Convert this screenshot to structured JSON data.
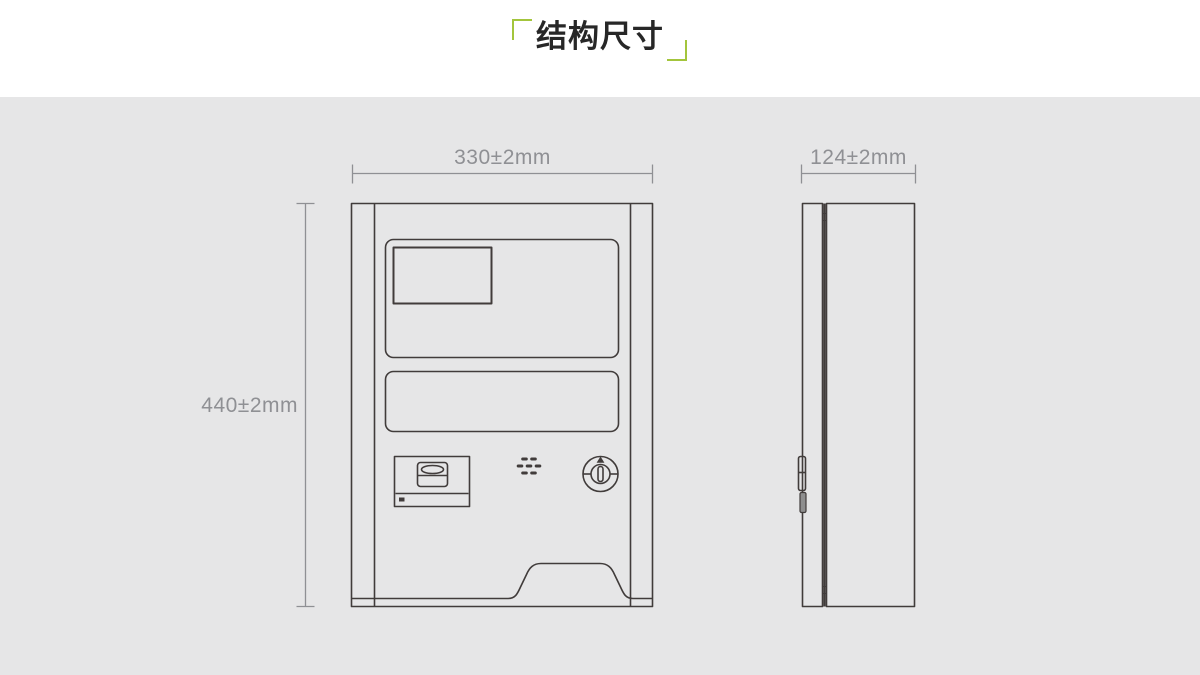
{
  "colors": {
    "bg": "#e6e6e7",
    "header_bg": "#ffffff",
    "accent": "#a3c53c",
    "title_color": "#272727",
    "line": "#413c3b",
    "dim": "#8f9094",
    "latch": "#8e8e8e"
  },
  "header": {
    "title": "结构尺寸"
  },
  "diagram": {
    "front_view": {
      "width": "330±2mm",
      "height": "440±2mm"
    },
    "side_view": {
      "depth": "124±2mm"
    }
  }
}
